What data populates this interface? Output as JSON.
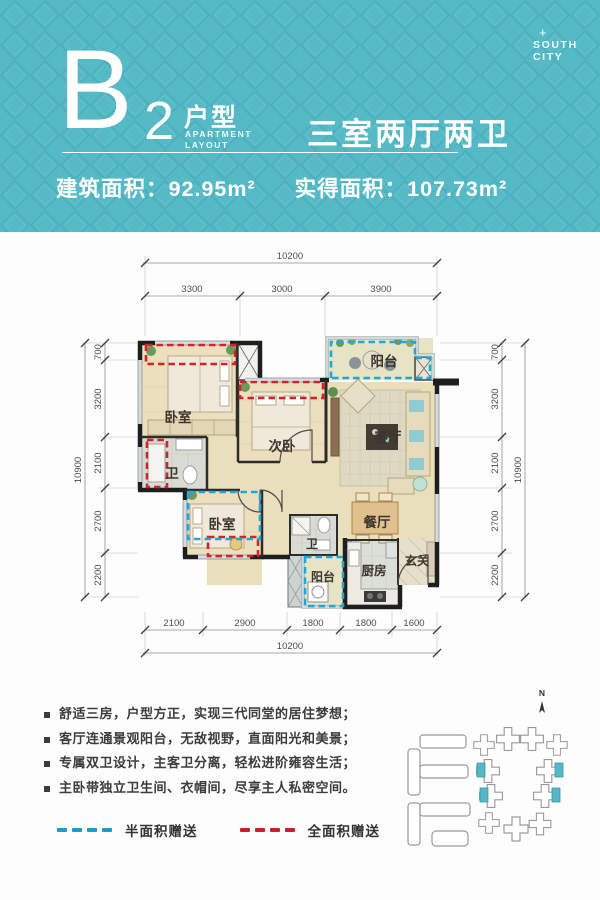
{
  "header": {
    "plan_letter": "B",
    "plan_number": "2",
    "plan_type": "户型",
    "plan_type_en_1": "APARTMENT",
    "plan_type_en_2": "LAYOUT",
    "rooms_summary": "三室两厅两卫",
    "area_built_label": "建筑面积：",
    "area_built_value": "92.95m²",
    "area_actual_label": "实得面积：",
    "area_actual_value": "107.73m²",
    "logo": {
      "plus": "+",
      "line1": "SOUTH",
      "line2": "CITY"
    }
  },
  "floorplan": {
    "room_labels": {
      "bedroom_master": "卧室",
      "bedroom_second": "次卧",
      "balcony_top": "阳台",
      "living_room": "客厅",
      "bath_left": "卫",
      "bedroom_third": "卧室",
      "bath_middle": "卫",
      "dining_room": "餐厅",
      "entry": "玄关",
      "kitchen": "厨房",
      "balcony_bottom": "阳台"
    },
    "dimensions": {
      "top_total": "10200",
      "top_segments": [
        "3300",
        "3000",
        "3900"
      ],
      "bottom_segments": [
        "2100",
        "2900",
        "1800",
        "1800",
        "1600"
      ],
      "bottom_total": "10200",
      "left_segments": [
        "700",
        "3200",
        "2100",
        "2700",
        "2200"
      ],
      "left_total": "10900",
      "right_segments": [
        "700",
        "3200",
        "2100",
        "2700",
        "2200"
      ],
      "right_total": "10900"
    }
  },
  "features": {
    "item_1": "舒适三房，户型方正，实现三代同堂的居住梦想；",
    "item_2": "客厅连通景观阳台，无敌视野，直面阳光和美景；",
    "item_3": "专属双卫设计，主客卫分离，轻松进阶雍容生活；",
    "item_4": "主卧带独立卫生间、衣帽间，尽享主人私密空间。"
  },
  "legend": {
    "half_label": "半面积赠送",
    "full_label": "全面积赠送",
    "half_color": "#2398cd",
    "full_color": "#cb2029"
  },
  "siteplan": {
    "north": "N"
  },
  "colors": {
    "teal": "#55b9c6"
  }
}
